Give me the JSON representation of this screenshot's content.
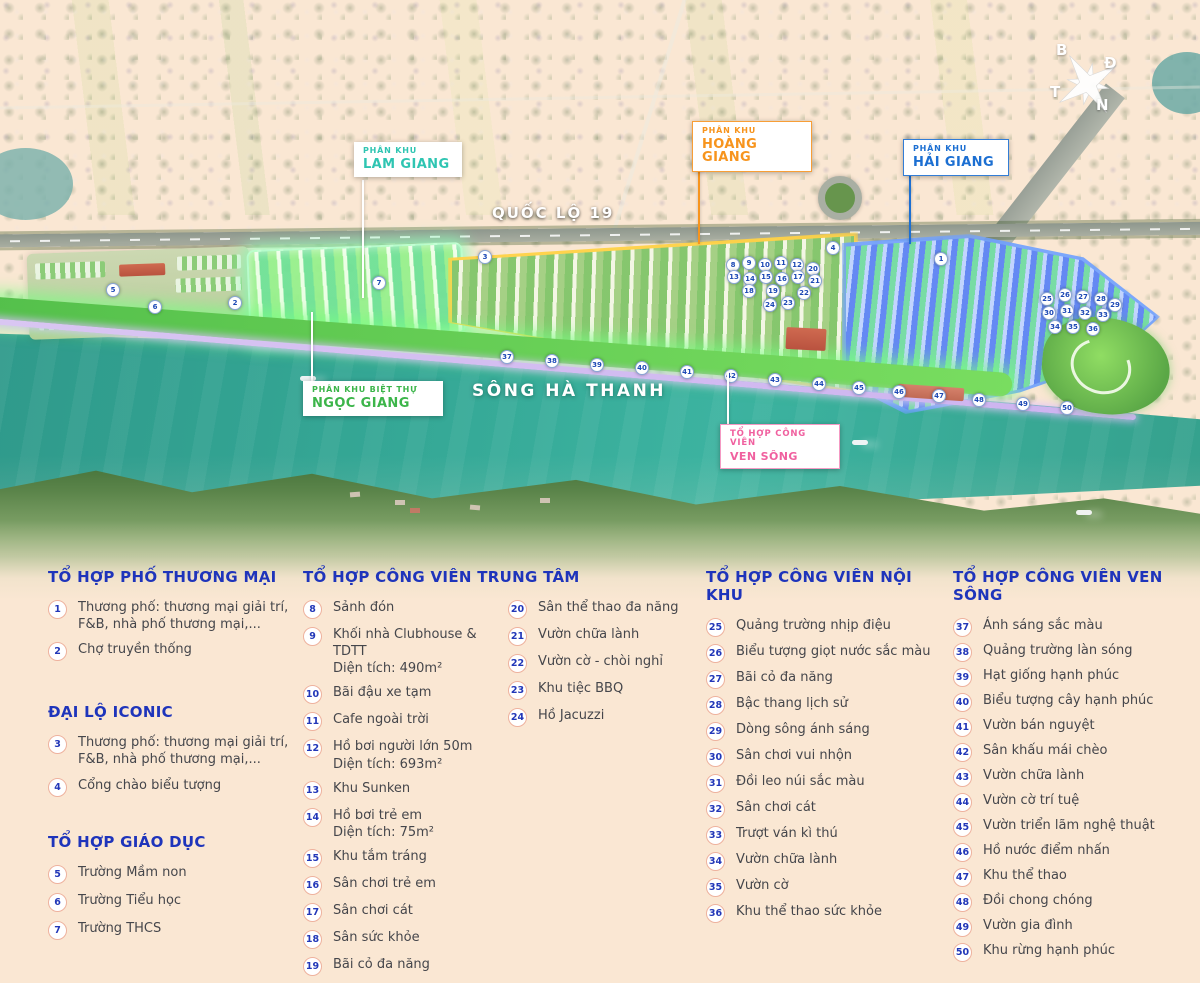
{
  "map": {
    "road_label": "QUỐC LỘ 19",
    "river_label": "SÔNG HÀ THANH",
    "labels": {
      "lam_giang": {
        "line1": "PHÂN KHU",
        "line2": "LAM GIANG",
        "color": "#2fc5b2"
      },
      "hoang_giang": {
        "line1": "PHÂN KHU",
        "line2": "HOÀNG GIANG",
        "color": "#f7941d"
      },
      "hai_giang": {
        "line1": "PHÂN KHU",
        "line2": "HẢI GIANG",
        "color": "#1c6fd2"
      },
      "ngoc_giang": {
        "line1": "PHÂN KHU BIỆT THỰ",
        "line2": "NGỌC GIANG",
        "color": "#3cb54a"
      },
      "ven_song": {
        "line1": "TỔ HỢP CÔNG VIÊN",
        "line2": "VEN SÔNG",
        "color": "#f0609f"
      }
    },
    "compass": {
      "north": "B",
      "east": "Đ",
      "south": "N",
      "west": "T"
    },
    "markers": [
      {
        "n": 1,
        "x": 934,
        "y": 252
      },
      {
        "n": 2,
        "x": 228,
        "y": 296
      },
      {
        "n": 3,
        "x": 478,
        "y": 250
      },
      {
        "n": 4,
        "x": 826,
        "y": 241
      },
      {
        "n": 5,
        "x": 106,
        "y": 283
      },
      {
        "n": 6,
        "x": 148,
        "y": 300
      },
      {
        "n": 7,
        "x": 372,
        "y": 276
      },
      {
        "n": 8,
        "x": 726,
        "y": 258
      },
      {
        "n": 9,
        "x": 742,
        "y": 256
      },
      {
        "n": 10,
        "x": 758,
        "y": 258
      },
      {
        "n": 11,
        "x": 774,
        "y": 256
      },
      {
        "n": 12,
        "x": 790,
        "y": 258
      },
      {
        "n": 13,
        "x": 727,
        "y": 270
      },
      {
        "n": 14,
        "x": 743,
        "y": 272
      },
      {
        "n": 15,
        "x": 759,
        "y": 270
      },
      {
        "n": 16,
        "x": 775,
        "y": 272
      },
      {
        "n": 17,
        "x": 791,
        "y": 270
      },
      {
        "n": 18,
        "x": 742,
        "y": 284
      },
      {
        "n": 19,
        "x": 766,
        "y": 284
      },
      {
        "n": 20,
        "x": 806,
        "y": 262
      },
      {
        "n": 21,
        "x": 808,
        "y": 274
      },
      {
        "n": 22,
        "x": 797,
        "y": 286
      },
      {
        "n": 23,
        "x": 781,
        "y": 296
      },
      {
        "n": 24,
        "x": 763,
        "y": 298
      },
      {
        "n": 25,
        "x": 1040,
        "y": 292
      },
      {
        "n": 26,
        "x": 1058,
        "y": 288
      },
      {
        "n": 27,
        "x": 1076,
        "y": 290
      },
      {
        "n": 28,
        "x": 1094,
        "y": 292
      },
      {
        "n": 29,
        "x": 1108,
        "y": 298
      },
      {
        "n": 30,
        "x": 1042,
        "y": 306
      },
      {
        "n": 31,
        "x": 1060,
        "y": 304
      },
      {
        "n": 32,
        "x": 1078,
        "y": 306
      },
      {
        "n": 33,
        "x": 1096,
        "y": 308
      },
      {
        "n": 34,
        "x": 1048,
        "y": 320
      },
      {
        "n": 35,
        "x": 1066,
        "y": 320
      },
      {
        "n": 36,
        "x": 1086,
        "y": 322
      },
      {
        "n": 37,
        "x": 500,
        "y": 350
      },
      {
        "n": 38,
        "x": 545,
        "y": 354
      },
      {
        "n": 39,
        "x": 590,
        "y": 358
      },
      {
        "n": 40,
        "x": 635,
        "y": 361
      },
      {
        "n": 41,
        "x": 680,
        "y": 365
      },
      {
        "n": 42,
        "x": 724,
        "y": 369
      },
      {
        "n": 43,
        "x": 768,
        "y": 373
      },
      {
        "n": 44,
        "x": 812,
        "y": 377
      },
      {
        "n": 45,
        "x": 852,
        "y": 381
      },
      {
        "n": 46,
        "x": 892,
        "y": 385
      },
      {
        "n": 47,
        "x": 932,
        "y": 389
      },
      {
        "n": 48,
        "x": 972,
        "y": 393
      },
      {
        "n": 49,
        "x": 1016,
        "y": 397
      },
      {
        "n": 50,
        "x": 1060,
        "y": 401
      }
    ]
  },
  "legend": {
    "heading_color": "#1e34bb",
    "commercial": {
      "title": "TỔ HỢP PHỐ THƯƠNG MẠI",
      "items": [
        {
          "n": 1,
          "t": "Thương phố: thương mại giải trí, F&B, nhà phố thương mại,..."
        },
        {
          "n": 2,
          "t": "Chợ truyền thống"
        }
      ]
    },
    "iconic": {
      "title": "ĐẠI LỘ ICONIC",
      "items": [
        {
          "n": 3,
          "t": "Thương phố: thương mại giải trí, F&B, nhà phố thương mại,..."
        },
        {
          "n": 4,
          "t": "Cổng chào biểu tượng"
        }
      ]
    },
    "education": {
      "title": "TỔ HỢP GIÁO DỤC",
      "items": [
        {
          "n": 5,
          "t": "Trường Mầm non"
        },
        {
          "n": 6,
          "t": "Trường Tiểu học"
        },
        {
          "n": 7,
          "t": "Trường THCS"
        }
      ]
    },
    "central_park": {
      "title": "TỔ HỢP CÔNG VIÊN TRUNG TÂM",
      "items_left": [
        {
          "n": 8,
          "t": "Sảnh đón"
        },
        {
          "n": 9,
          "t": "Khối nhà Clubhouse & TDTT",
          "sub": "Diện tích: 490m²"
        },
        {
          "n": 10,
          "t": "Bãi đậu xe tạm"
        },
        {
          "n": 11,
          "t": "Cafe ngoài trời"
        },
        {
          "n": 12,
          "t": "Hồ bơi người lớn 50m",
          "sub": "Diện tích: 693m²"
        },
        {
          "n": 13,
          "t": "Khu Sunken"
        },
        {
          "n": 14,
          "t": "Hồ bơi trẻ em",
          "sub": "Diện tích: 75m²"
        },
        {
          "n": 15,
          "t": "Khu tắm tráng"
        },
        {
          "n": 16,
          "t": "Sân chơi trẻ em"
        },
        {
          "n": 17,
          "t": "Sân chơi cát"
        },
        {
          "n": 18,
          "t": "Sân sức khỏe"
        },
        {
          "n": 19,
          "t": "Bãi cỏ đa năng"
        }
      ],
      "items_right": [
        {
          "n": 20,
          "t": "Sân thể thao đa năng"
        },
        {
          "n": 21,
          "t": "Vườn chữa lành"
        },
        {
          "n": 22,
          "t": "Vườn cờ - chòi nghỉ"
        },
        {
          "n": 23,
          "t": "Khu tiệc BBQ"
        },
        {
          "n": 24,
          "t": "Hồ Jacuzzi"
        }
      ]
    },
    "inner_park": {
      "title": "TỔ HỢP CÔNG VIÊN NỘI KHU",
      "items": [
        {
          "n": 25,
          "t": "Quảng trường nhịp điệu"
        },
        {
          "n": 26,
          "t": "Biểu tượng giọt nước sắc màu"
        },
        {
          "n": 27,
          "t": "Bãi cỏ đa năng"
        },
        {
          "n": 28,
          "t": "Bậc thang lịch sử"
        },
        {
          "n": 29,
          "t": "Dòng sông ánh sáng"
        },
        {
          "n": 30,
          "t": "Sân chơi vui nhộn"
        },
        {
          "n": 31,
          "t": "Đồi leo núi sắc màu"
        },
        {
          "n": 32,
          "t": "Sân chơi cát"
        },
        {
          "n": 33,
          "t": "Trượt ván kì thú"
        },
        {
          "n": 34,
          "t": "Vườn chữa lành"
        },
        {
          "n": 35,
          "t": "Vườn cờ"
        },
        {
          "n": 36,
          "t": "Khu thể thao sức khỏe"
        }
      ]
    },
    "riverside_park": {
      "title": "TỔ HỢP CÔNG VIÊN VEN SÔNG",
      "items": [
        {
          "n": 37,
          "t": "Ánh sáng sắc màu"
        },
        {
          "n": 38,
          "t": "Quảng trường làn sóng"
        },
        {
          "n": 39,
          "t": "Hạt giống hạnh phúc"
        },
        {
          "n": 40,
          "t": "Biểu tượng cây hạnh phúc"
        },
        {
          "n": 41,
          "t": "Vườn bán nguyệt"
        },
        {
          "n": 42,
          "t": "Sân khấu mái chèo"
        },
        {
          "n": 43,
          "t": "Vườn chữa lành"
        },
        {
          "n": 44,
          "t": "Vườn cờ trí tuệ"
        },
        {
          "n": 45,
          "t": "Vườn triển lãm nghệ thuật"
        },
        {
          "n": 46,
          "t": "Hồ nước điểm nhấn"
        },
        {
          "n": 47,
          "t": "Khu thể thao"
        },
        {
          "n": 48,
          "t": "Đồi chong chóng"
        },
        {
          "n": 49,
          "t": "Vườn gia đình"
        },
        {
          "n": 50,
          "t": "Khu rừng hạnh phúc"
        }
      ]
    }
  }
}
